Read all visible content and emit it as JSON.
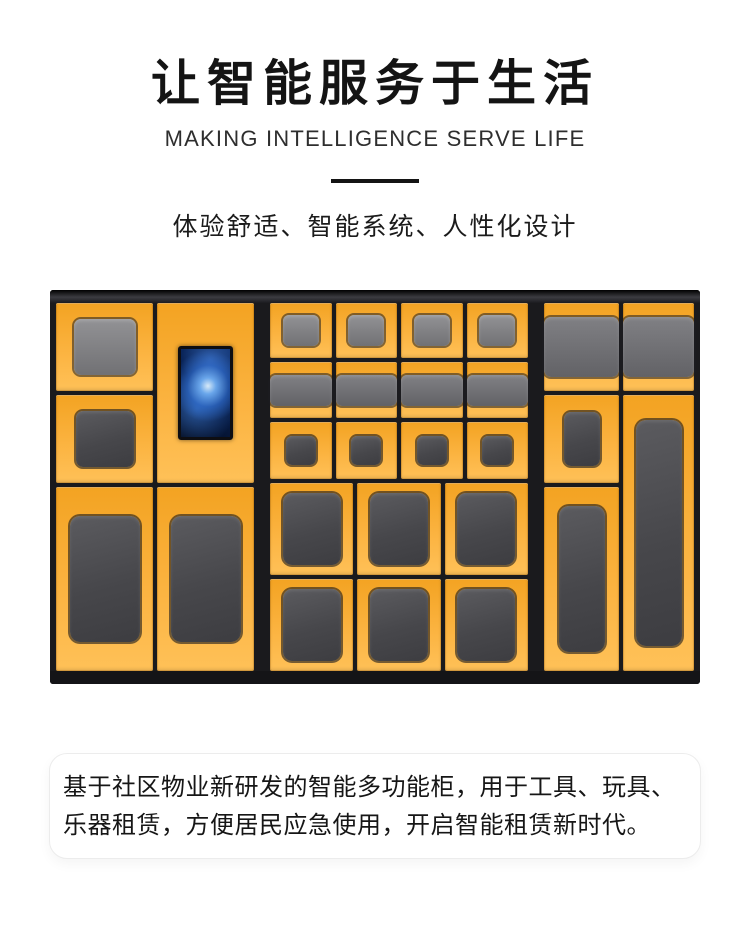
{
  "hero": {
    "title": "让智能服务于生活",
    "subtitle": "MAKING INTELLIGENCE SERVE LIFE",
    "tagline": "体验舒适、智能系统、人性化设计"
  },
  "product_image": {
    "label": "智能多功能柜",
    "type": "smart-locker-cabinet-photo",
    "has_touchscreen": true,
    "compartment_layout": {
      "left_section_doors": 5,
      "middle_small_doors": 12,
      "middle_medium_doors": 6,
      "right_section_doors": 5
    },
    "colors": {
      "cabinet_yellow": "#FBAF33",
      "cabinet_yellow_light": "#FFC158",
      "frame_dark": "#1A1A1D",
      "window_gray_light": "#8A8A8D",
      "window_gray_dark": "#47474B",
      "screen_glow_blue": "#7EC0FF",
      "screen_base_blue": "#082050"
    }
  },
  "description": {
    "text": "基于社区物业新研发的智能多功能柜，用于工具、玩具、乐器租赁，方便居民应急使用，开启智能租赁新时代。"
  }
}
